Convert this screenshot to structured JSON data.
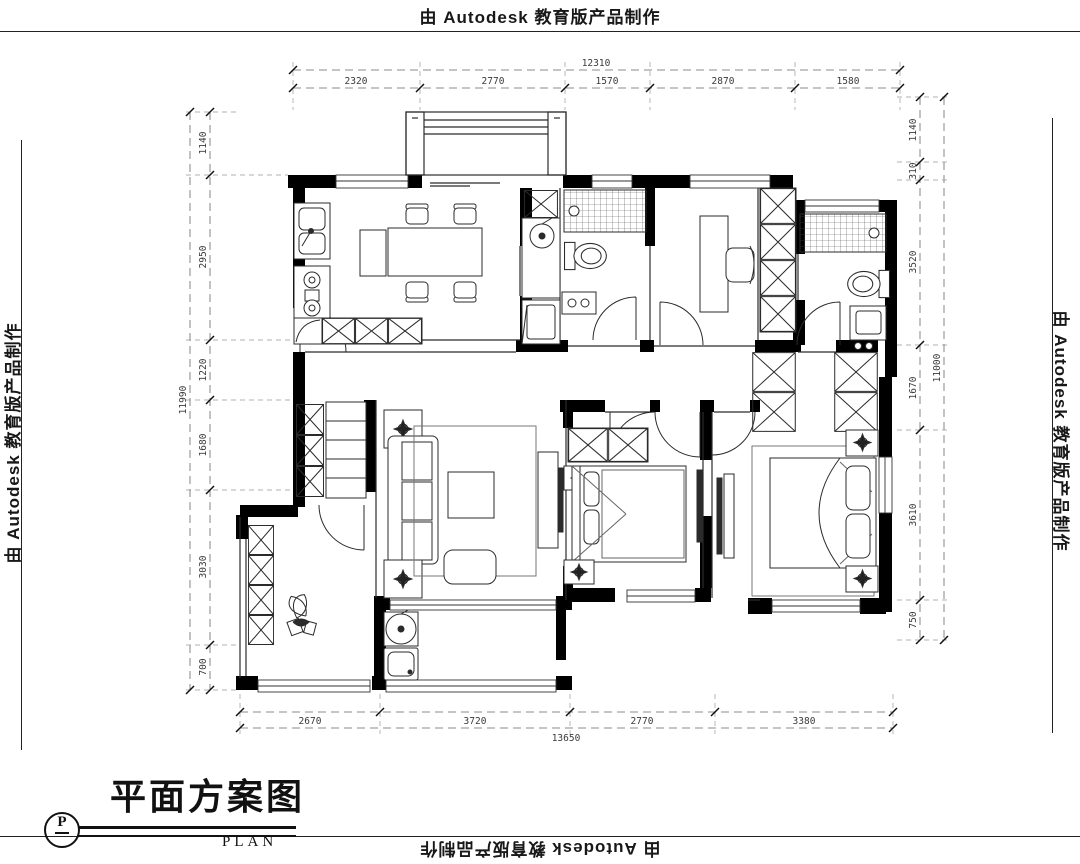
{
  "watermark": {
    "text": "由 Autodesk 教育版产品制作"
  },
  "title_block": {
    "title": "平面方案图",
    "subtitle": "PLAN",
    "symbol": "P"
  },
  "dimensions": {
    "top": {
      "total": "12310",
      "segments": [
        "2320",
        "2770",
        "1570",
        "2870",
        "1580"
      ]
    },
    "bottom": {
      "total": "13650",
      "segments": [
        "2670",
        "3720",
        "2770",
        "3380"
      ]
    },
    "left": {
      "total": "11990",
      "segments": [
        "1140",
        "2950",
        "1220",
        "1680",
        "3030",
        "700"
      ]
    },
    "right": {
      "total": "11000",
      "segments": [
        "1140",
        "310",
        "3520",
        "1670",
        "3610",
        "750"
      ]
    }
  },
  "colors": {
    "ink": "#1a1a1a",
    "wall": "#000000",
    "dim": "#3a3a3a"
  }
}
